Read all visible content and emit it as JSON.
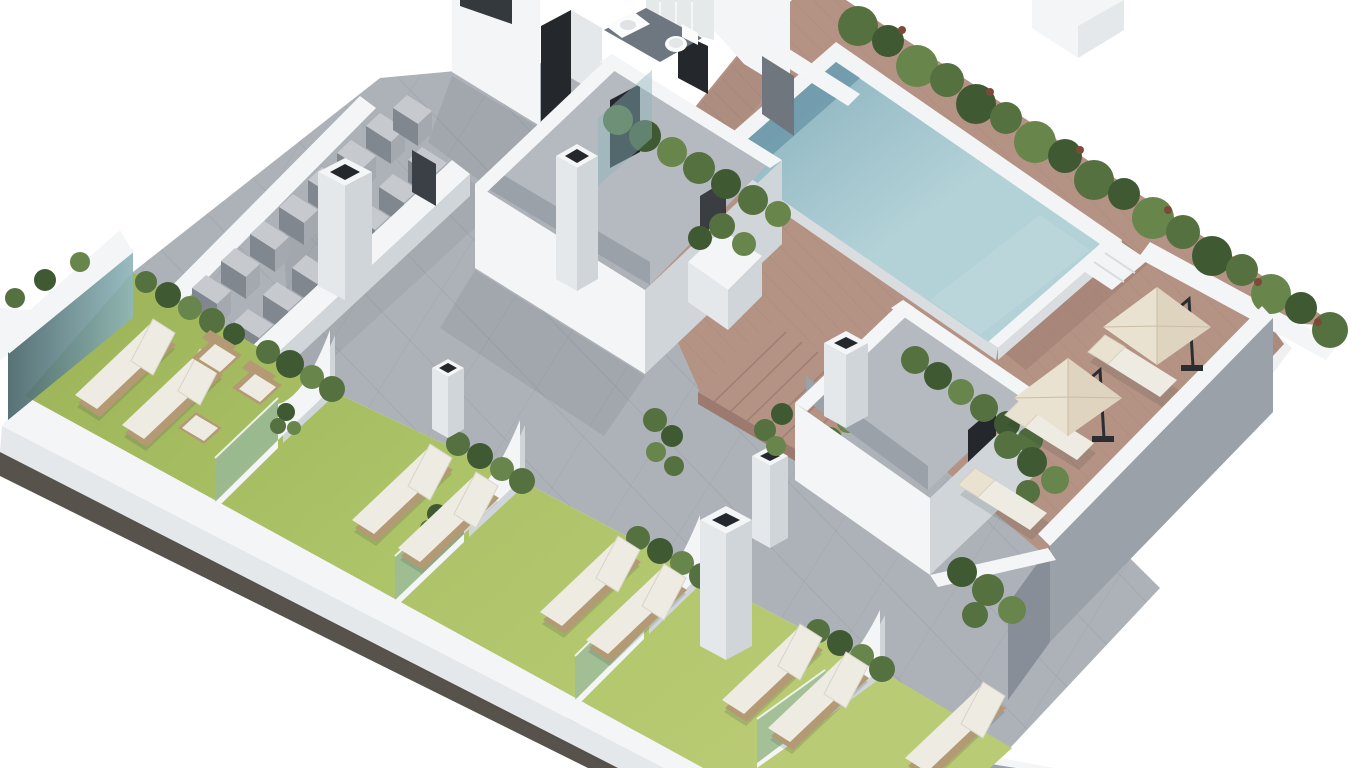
{
  "title": "Isometric 3D architectural render of a residential rooftop terrace with swimming pool, timber deck, lawn sunbathing bays and plant rooms",
  "view": {
    "width": 1366,
    "height": 768
  },
  "palette": {
    "bg": "#ffffff",
    "tile": "#adb2b8",
    "tile-line": "#99a0a7",
    "wood": "#b59384",
    "wood-line": "#a27f75",
    "wood-shade": "#9c7a70",
    "lawn": "#adc368",
    "lawn-dark": "#9cb257",
    "water-1": "#86aebb",
    "water-2": "#b3d2d8",
    "water-wall": "#6f9aab",
    "water-light": "#c2dade",
    "coping": "#f2f4f5",
    "coping-shade": "#d9dde0",
    "wall-lit": "#f3f5f6",
    "wall-mid": "#e4e8ea",
    "wall-shade": "#cfd5d9",
    "grey-wall": "#9aa1a9",
    "grey-wall-dark": "#878e97",
    "hedge-dark": "#3f5a33",
    "hedge-mid": "#54713f",
    "hedge-light": "#68854c",
    "flower": "#7e4a38",
    "ac-top": "#c6cacf",
    "ac-face": "#81878e",
    "ac-side": "#a3a9af",
    "rattan": "#b49a74",
    "cushion": "#edebe2",
    "umbrella": "#eae2d0",
    "umbrella-shade": "#d9cdb5",
    "seam": "#c9bda4",
    "glass": "#8fb6ba",
    "glass-dark": "#49666a",
    "door-dark": "#24282d",
    "door-grey": "#70767d",
    "gate": "#3a4046",
    "base-dark": "#463f39",
    "metal": "#2b2e31",
    "interior": "#b4bac0",
    "floor-dark": "#6e7680",
    "shadow": "#1c2b33"
  },
  "labels": {
    "scene": "Rooftop terrace 3D render",
    "terrace": "Grey tiled rooftop terrace",
    "deck": "Hardwood pool deck",
    "pool": "Swimming pool",
    "pool_steps": "Pool access steps",
    "hedge_row": "Perimeter hedge planter with flowering shrubs",
    "lawn": "Artificial lawn sunbathing bays",
    "partition": "Curved bay divider wall with glass panel",
    "sw_wall": "Lower perimeter parapet wall",
    "glass_balustrade": "Glass balustrade at west corner",
    "ac_zone": "Air-conditioning condenser plant area",
    "ac_unit": "Air-conditioning condenser unit",
    "chimney": "Ventilation chimney",
    "stair_bulkhead": "Stair bulkhead with perimeter planters",
    "stair_room_2": "Secondary stair bulkhead with planters",
    "wood_steps": "Timber steps up to pool deck",
    "bathroom": "Cut-away bathroom with WC and basin",
    "buildings": "Core building volumes (cut by frame)",
    "parasol": "Cream cantilever parasol",
    "deck_lounger": "Poolside sun lounger",
    "lawn_lounger": "Lawn sun lounger",
    "armchair": "Wicker lounge armchair",
    "ottoman": "Wicker ottoman",
    "perimeter_wall": "Boundary wall (south-east)",
    "gate": "Dark access gate",
    "planter": "White planter pillar with shrubs"
  },
  "inventory": {
    "lawn_bays": 5,
    "lawn_loungers": 9,
    "wicker_armchairs": 2,
    "ottomans": 1,
    "deck_loungers": 3,
    "parasols": 2,
    "ac_units": 15,
    "chimneys": 6,
    "partition_walls": 4,
    "pools": 1,
    "bathrooms": 1
  }
}
